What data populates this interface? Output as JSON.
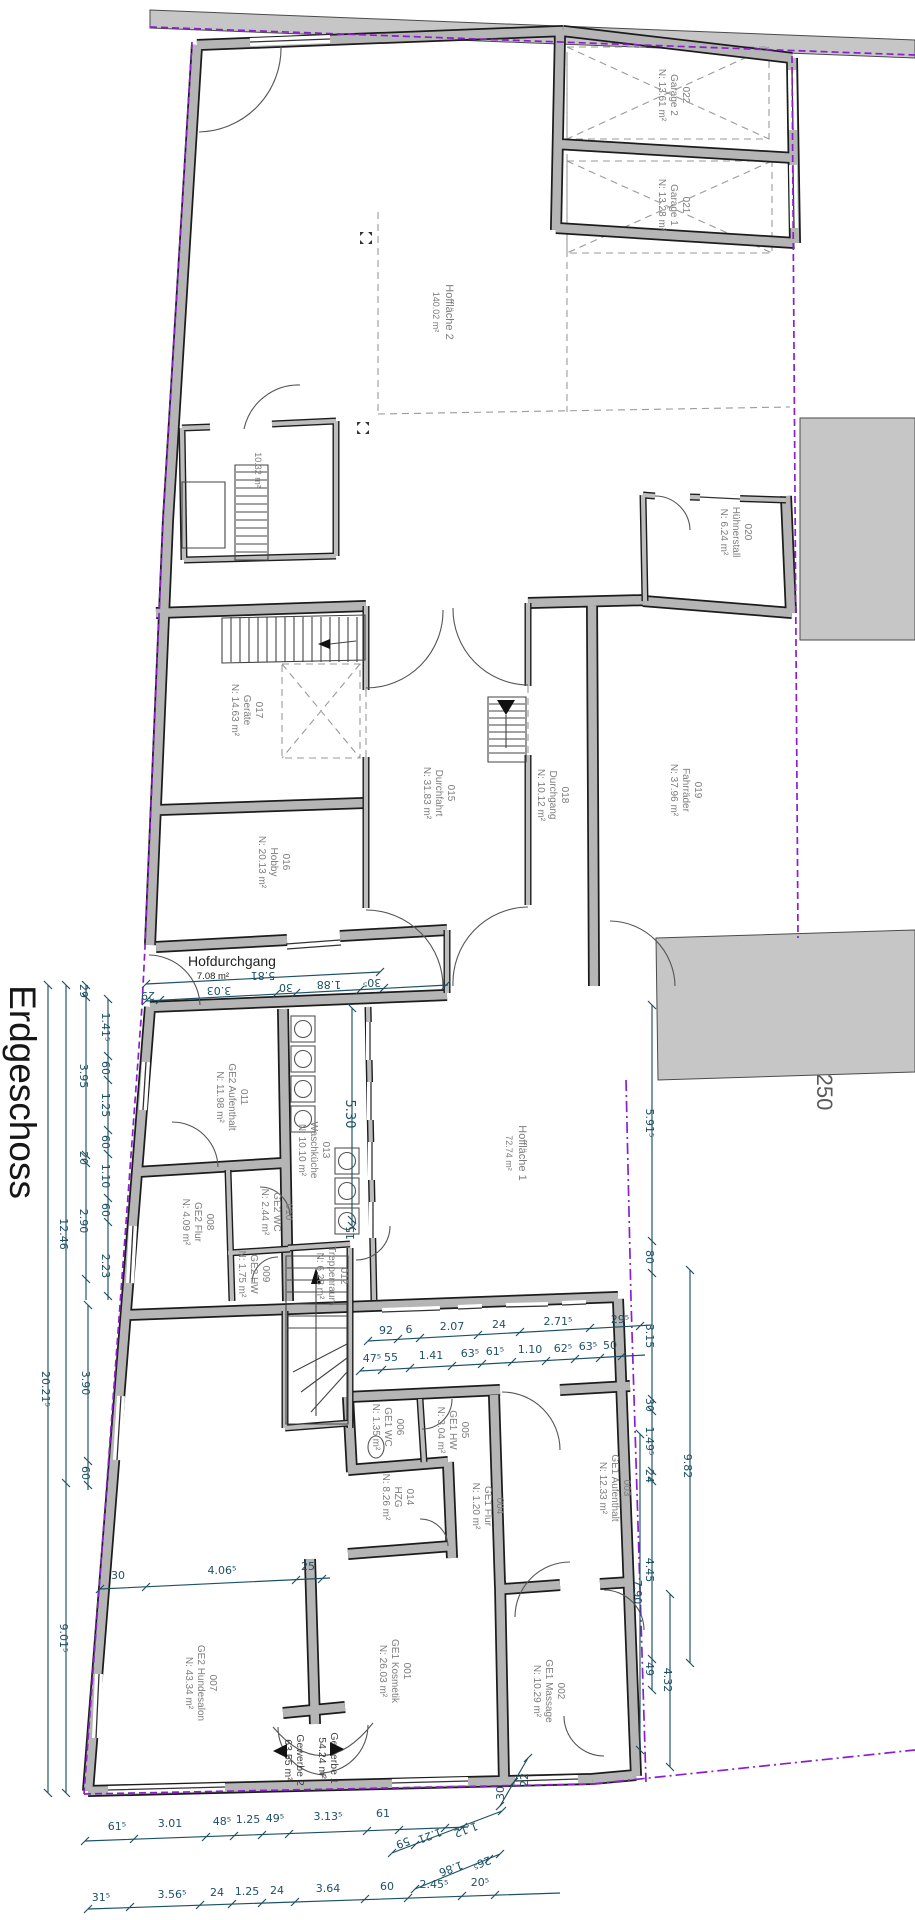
{
  "title": "Erdgeschoss",
  "scale": "250",
  "areas": {
    "hofflaeche2": {
      "name": "Hoffläche 2",
      "area": "140.02 m²"
    },
    "hofflaeche1": {
      "name": "Hoffläche 1",
      "area": "72.74 m²"
    },
    "hofdurchgang": {
      "name": "Hofdurchgang",
      "area": "7.08 m²"
    },
    "abstell": {
      "area": "10.32 m²"
    },
    "gewerbe1": {
      "name": "Gewerbe 1",
      "area": "54.24 m²"
    },
    "gewerbe2": {
      "name": "Gewerbe 2",
      "area": "63.55 m²"
    }
  },
  "rooms": [
    {
      "id": "022",
      "name": "Garage 2",
      "area": "N: 13.61 m²"
    },
    {
      "id": "021",
      "name": "Garage 1",
      "area": "N: 13.28 m²"
    },
    {
      "id": "020",
      "name": "Hühnerstall",
      "area": "N: 6.24 m²"
    },
    {
      "id": "017",
      "name": "Geräte",
      "area": "N: 14.63 m²"
    },
    {
      "id": "016",
      "name": "Hobby",
      "area": "N: 20.13 m²"
    },
    {
      "id": "015",
      "name": "Durchfahrt",
      "area": "N: 31.83 m²"
    },
    {
      "id": "018",
      "name": "Durchgang",
      "area": "N: 10.12 m²"
    },
    {
      "id": "019",
      "name": "Fahrräder",
      "area": "N: 37.96 m²"
    },
    {
      "id": "011",
      "name": "GE2 Aufenthalt",
      "area": "N: 11.98 m²"
    },
    {
      "id": "013",
      "name": "Waschküche",
      "area": "N: 10.10 m²"
    },
    {
      "id": "010",
      "name": "GE2 WC",
      "area": "N: 2.44 m²"
    },
    {
      "id": "008",
      "name": "GE2 Flur",
      "area": "N: 4.09 m²"
    },
    {
      "id": "009",
      "name": "GE2 HW",
      "area": "N: 1.75 m²"
    },
    {
      "id": "012",
      "name": "Treppenraum",
      "area": "N: 6.28 m²"
    },
    {
      "id": "006",
      "name": "GE1 WC",
      "area": "N: 1.35 m²"
    },
    {
      "id": "005",
      "name": "GE1 HW",
      "area": "N: 3.04 m²"
    },
    {
      "id": "014",
      "name": "HZG",
      "area": "N: 8.26 m²"
    },
    {
      "id": "004",
      "name": "GE1 Flur",
      "area": "N: 1.20 m²"
    },
    {
      "id": "003",
      "name": "GE1 Aufenthalt",
      "area": "N: 12.33 m²"
    },
    {
      "id": "007",
      "name": "GE2 Hundesalon",
      "area": "N: 43.34 m²"
    },
    {
      "id": "001",
      "name": "GE1 Kosmetik",
      "area": "N: 26.03 m²"
    },
    {
      "id": "002",
      "name": "GE1 Massage",
      "area": "N: 10.29 m²"
    }
  ],
  "dimensions": {
    "hof_total": "5.81",
    "hof_parts": [
      "29",
      "3.03",
      "30",
      "1.88",
      "30⁵"
    ],
    "court_row1": [
      "92",
      "6",
      "2.07",
      "24",
      "2.71⁵",
      "29⁵"
    ],
    "court_row2": [
      "47⁵",
      "55",
      "1.41",
      "63⁵",
      "61⁵",
      "1.10",
      "62⁵",
      "63⁵",
      "50"
    ],
    "wasch": [
      "5.30",
      "15"
    ],
    "left_total": "20.21⁵",
    "left_mid": [
      "12.46",
      "9.01⁵"
    ],
    "left_a": [
      "29",
      "3.95",
      "20",
      "2.90"
    ],
    "left_b": [
      "1.41⁵",
      "60",
      "1.25",
      "60",
      "1.10",
      "60",
      "2.23"
    ],
    "left_d": [
      "3.90",
      "60"
    ],
    "right_a": [
      "5.91⁵",
      "80",
      "3.15",
      "30",
      "1.49⁵",
      "24",
      "4.45",
      "49"
    ],
    "right_b": "9.82",
    "right_c": "7.90",
    "right_d": "4.32",
    "hund": [
      "30",
      "4.06⁵",
      "25"
    ],
    "bottom1": [
      "61⁵",
      "3.01",
      "48⁵",
      "1.25",
      "49⁵",
      "3.13⁵",
      "61"
    ],
    "slant1": [
      "59",
      "1.21",
      "1.12"
    ],
    "slant2": [
      "1.86",
      "26⁵"
    ],
    "corner": [
      "30",
      "22"
    ],
    "bottom2": [
      "31⁵",
      "3.56⁵",
      "24",
      "1.25",
      "24",
      "3.64",
      "60",
      "2.45⁵",
      "20⁵"
    ]
  },
  "colors": {
    "wall_fill": "#b5b5b5",
    "dimension": "#1d5166",
    "boundary": "#8b1fd0",
    "room_text": "#7d7d7d"
  }
}
